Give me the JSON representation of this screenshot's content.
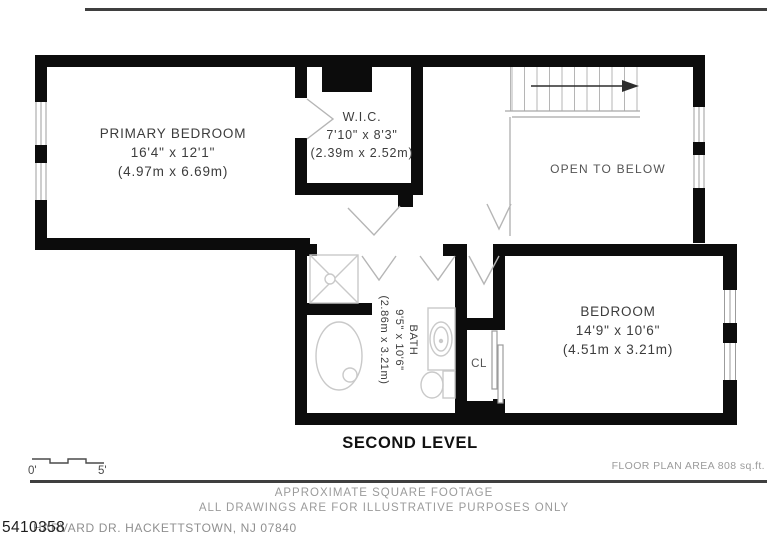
{
  "rooms": {
    "primary_bedroom": {
      "name": "PRIMARY BEDROOM",
      "dims_ft": "16'4\" x 12'1\"",
      "dims_m": "(4.97m x 6.69m)"
    },
    "wic": {
      "name": "W.I.C.",
      "dims_ft": "7'10\" x 8'3\"",
      "dims_m": "(2.39m x 2.52m)"
    },
    "bedroom": {
      "name": "BEDROOM",
      "dims_ft": "14'9\" x 10'6\"",
      "dims_m": "(4.51m x 3.21m)"
    },
    "bath": {
      "name": "BATH",
      "dims_ft": "9'5\" x 10'6\"",
      "dims_m": "(2.86m x 3.21m)"
    },
    "closet": {
      "name": "CL"
    },
    "open_to_below": {
      "name": "OPEN TO BELOW"
    }
  },
  "title": {
    "level": "SECOND LEVEL"
  },
  "scale_bar": {
    "start": "0'",
    "end": "5'"
  },
  "footer": {
    "floor_area": "FLOOR PLAN AREA 808 sq.ft.",
    "line1": "APPROXIMATE SQUARE FOOTAGE",
    "line2": "ALL DRAWINGS ARE FOR ILLUSTRATIVE PURPOSES ONLY",
    "listing_number": "5410358",
    "address": "HARVARD DR. HACKETTSTOWN, NJ 07840"
  },
  "colors": {
    "wall": "#0c0c0c",
    "fixture_line": "#c9c9c9",
    "thin_line": "#a6a6a6",
    "label_text": "#3c3c3c",
    "muted_text": "#9b9b9b"
  }
}
